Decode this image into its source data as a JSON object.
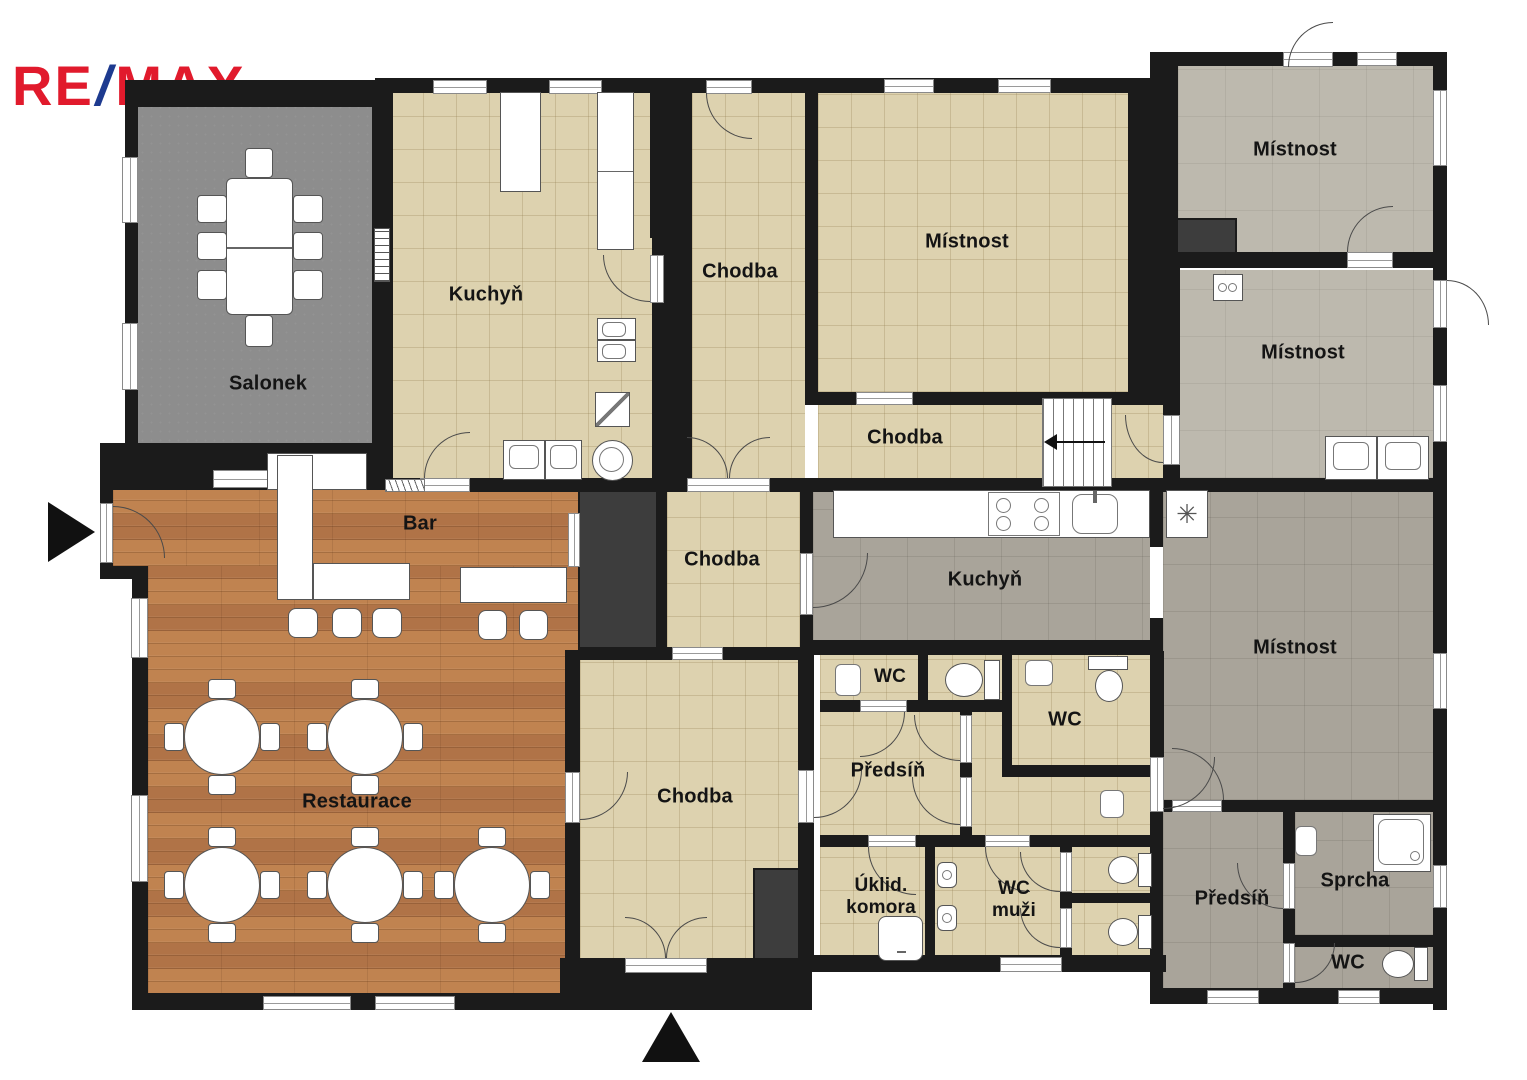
{
  "logo": {
    "re": "RE",
    "slash": "/",
    "max": "MAX"
  },
  "rooms": {
    "salonek": "Salonek",
    "kuchyn_top": "Kuchyň",
    "chodba_top": "Chodba",
    "mistnost_center": "Místnost",
    "chodba_center": "Chodba",
    "mistnost_ne": "Místnost",
    "mistnost_e": "Místnost",
    "bar": "Bar",
    "chodba_mid": "Chodba",
    "kuchyn_gray": "Kuchyň",
    "mistnost_se": "Místnost",
    "restaurace": "Restaurace",
    "chodba_bottom": "Chodba",
    "wc_small": "WC",
    "wc_large": "WC",
    "predsin": "Předsíň",
    "uklid_line1": "Úklid.",
    "uklid_line2": "komora",
    "wc_muzi_line1": "WC",
    "wc_muzi_line2": "muži",
    "predsin_se": "Předsíň",
    "sprcha": "Sprcha",
    "wc_se": "WC"
  },
  "colors": {
    "brand_red": "#e11a2c",
    "brand_blue": "#1d3a8f",
    "wall": "#1b1b1b",
    "shaft": "#3d3d3d",
    "beige": "#ddd2af",
    "concrete": "#bdb9ae",
    "warmgray": "#a9a49a",
    "salonek": "#8d8d8d",
    "wood": "#b87c4e"
  }
}
